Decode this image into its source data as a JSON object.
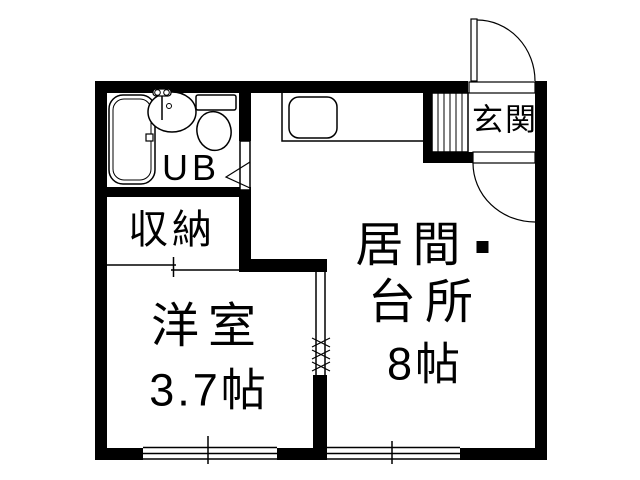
{
  "page": {
    "type": "apartment-floorplan",
    "background_color": "#ffffff",
    "line_color": "#000000",
    "text_color": "#000000"
  },
  "rooms": {
    "unit_bath": {
      "label": "UB"
    },
    "entrance": {
      "label": "玄関"
    },
    "closet": {
      "label": "収納"
    },
    "western_room": {
      "name": "洋室",
      "size": "3.7帖"
    },
    "living_dining_kitchen": {
      "name_line1": "居間",
      "separator": "・",
      "name_line2": "台所",
      "size": "8帖"
    }
  },
  "fixtures": {
    "bathtub": "bathtub",
    "washbasin": "washbasin",
    "toilet": "toilet",
    "kitchen_counter": "kitchen-counter",
    "kitchen_sink": "kitchen-sink",
    "shoe_cabinet": "shoe-cabinet",
    "entrance_door": "swing-door",
    "hall_door": "swing-door",
    "ub_door": "hinged-door",
    "closet_door": "sliding-door",
    "windows": "sliding-window",
    "room_opening": "open-passage"
  }
}
